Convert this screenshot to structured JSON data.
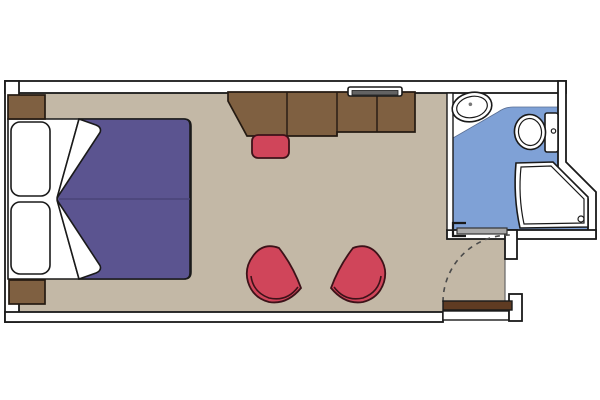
{
  "plan": {
    "kind": "cabin-floor-plan",
    "rooms": [
      "main-cabin",
      "bathroom",
      "entry"
    ],
    "furniture": [
      "twin-bed-left",
      "twin-bed-right",
      "pillow-top",
      "pillow-bottom",
      "nightstand-top",
      "nightstand-bottom",
      "duvet",
      "duvet-fold-top",
      "duvet-fold-bottom",
      "desk-wardrobe-unit",
      "tv-shelf",
      "desk-stool",
      "armchair-left",
      "armchair-right",
      "entry-door",
      "entry-door-swing",
      "bathroom-sliding-door",
      "sink",
      "faucet-dot",
      "toilet",
      "toilet-tank",
      "flush-button",
      "shower-tray",
      "shower-drain"
    ],
    "palette": {
      "wall-line": "#1a1a1a",
      "wall-fill": "#ffffff",
      "floor": "#c3b8a6",
      "bathroom-floor": "#7fa1d6",
      "bedding": "#5b5490",
      "bedding-seam": "#4a4478",
      "furniture-brown": "#7f6041",
      "door-brown": "#5f3b22",
      "accent-red": "#d0455a",
      "red-dark": "#3d1219",
      "door-gray": "#a9a9a9",
      "tv-dark": "#636363",
      "swing-line": "#4a4a4a",
      "edge-gray": "#666666"
    }
  }
}
